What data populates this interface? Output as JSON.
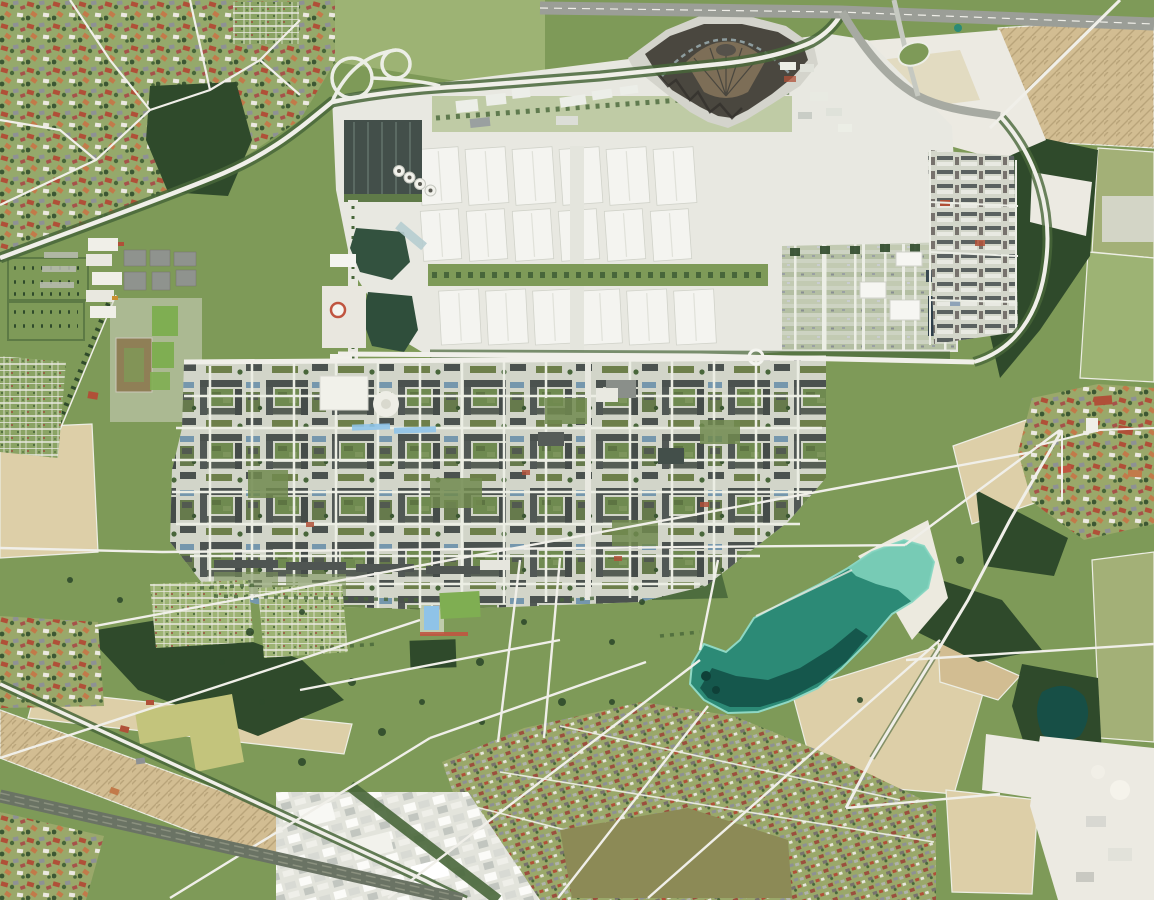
{
  "scene": {
    "description": "Aerial orthophoto, top-down: white trade-fair exhibition halls in three rows, a dark fan-shaped hall complex at top, a dense residential quarter with green courtyards in the middle, a large landscape park crossed by white paths, a turquoise bathing lake with a sand beach, surrounded by tan and green farm fields, villages with red roofs, a motorway at the top edge, a railway at lower left and white gravel pits at the right edge.",
    "landmarks": [
      {
        "id": "exhibition-halls",
        "label": "Three rows of white exhibition halls"
      },
      {
        "id": "fan-hall",
        "label": "Dark fan-shaped hall complex with brown radial roof"
      },
      {
        "id": "housing-district",
        "label": "Dense residential quarter with green courtyards"
      },
      {
        "id": "bathing-lake",
        "label": "Turquoise bathing lake with sand beach"
      },
      {
        "id": "landscape-park",
        "label": "Park meadows crossed by white diagonal paths"
      },
      {
        "id": "autobahn",
        "label": "Motorway along the top edge"
      },
      {
        "id": "railway",
        "label": "Railway line lower left"
      },
      {
        "id": "farm-fields",
        "label": "Tan, olive and green farm fields"
      },
      {
        "id": "villages",
        "label": "Villages with red and grey roofed houses"
      },
      {
        "id": "gravel-works",
        "label": "White gravel pits and works areas on the right"
      }
    ],
    "messe": {
      "hall_rows": [
        {
          "y": 148,
          "h": 56,
          "w": 40,
          "tilt": -4,
          "xs": [
            420,
            467,
            514,
            561,
            608,
            655
          ]
        },
        {
          "y": 210,
          "h": 50,
          "w": 38,
          "tilt": -4,
          "xs": [
            422,
            468,
            514,
            560,
            606,
            652
          ]
        },
        {
          "y": 290,
          "h": 54,
          "w": 40,
          "tilt": -3,
          "xs": [
            440,
            487,
            534,
            581,
            628,
            675
          ]
        }
      ],
      "tank_circles": {
        "count": 4,
        "cx": 399,
        "cy": 171,
        "dx": 10.5,
        "dy": 6.5,
        "r": 5.5
      }
    },
    "park": {
      "paths": [
        [
          0,
          548,
          162,
          552
        ],
        [
          162,
          552,
          905,
          545
        ],
        [
          95,
          626,
          1032,
          452
        ],
        [
          0,
          758,
          420,
          620
        ],
        [
          388,
          898,
          700,
          660
        ],
        [
          558,
          898,
          708,
          706
        ],
        [
          170,
          898,
          430,
          738
        ],
        [
          430,
          738,
          646,
          662
        ],
        [
          648,
          898,
          940,
          640
        ],
        [
          905,
          545,
          1060,
          430
        ],
        [
          520,
          560,
          498,
          742
        ],
        [
          560,
          558,
          544,
          738
        ],
        [
          718,
          560,
          700,
          650
        ],
        [
          300,
          690,
          560,
          640
        ],
        [
          906,
          660,
          1154,
          644
        ],
        [
          846,
          808,
          1000,
          794
        ]
      ],
      "trees": [
        [
          250,
          632,
          4
        ],
        [
          302,
          612,
          3
        ],
        [
          352,
          682,
          4
        ],
        [
          422,
          702,
          3
        ],
        [
          480,
          662,
          4
        ],
        [
          524,
          622,
          3
        ],
        [
          562,
          702,
          4
        ],
        [
          612,
          642,
          3
        ],
        [
          642,
          602,
          3
        ],
        [
          382,
          732,
          4
        ],
        [
          302,
          762,
          4
        ],
        [
          262,
          702,
          3
        ],
        [
          222,
          662,
          3
        ],
        [
          482,
          722,
          3
        ],
        [
          552,
          762,
          4
        ],
        [
          612,
          702,
          3
        ],
        [
          660,
          730,
          4
        ],
        [
          740,
          740,
          3
        ],
        [
          860,
          700,
          3
        ],
        [
          960,
          560,
          4
        ],
        [
          120,
          600,
          3
        ],
        [
          70,
          580,
          3
        ]
      ]
    }
  },
  "palette": {
    "parkGreen": "#7e9a58",
    "meadowLight": "#9db374",
    "suburbBase": "#95a96b",
    "villageBase": "#9aa86a",
    "grassBright": "#7fae52",
    "forest": "#2f4a2b",
    "forestMid": "#48663a",
    "treeRow": "#3c5733",
    "fieldTan": "#d2bd92",
    "fieldTanLight": "#ddcfa8",
    "fieldOlive": "#8c8a56",
    "fieldYellowGreen": "#c3c47c",
    "fieldGreen": "#a3b077",
    "trackBrown": "#8f7f56",
    "roadWhite": "#f0efe9",
    "highway": "#9b9e97",
    "asphalt": "#a7aaa2",
    "pavement": "#dcdcd4",
    "pavementLight": "#e8e8e1",
    "hallWhite": "#f4f4f0",
    "streetsBase": "#d2d5c9",
    "roofDark": "#4b524f",
    "roofRed": "#b05038",
    "roofOrange": "#c27a4a",
    "roofGray": "#8e9194",
    "glassDark": "#434f4a",
    "fanDark": "#4a473f",
    "fanBrown": "#7d6e57",
    "pondGreen": "#33523f",
    "waterDark": "#14544a",
    "waterMid": "#2c8a76",
    "waterLight": "#7fd2bd",
    "beach": "#eceadf",
    "poolBlue": "#8fc3e8",
    "quarryWhite": "#eceae2",
    "railDark": "#6a7364",
    "accentRed": "#c05540"
  }
}
